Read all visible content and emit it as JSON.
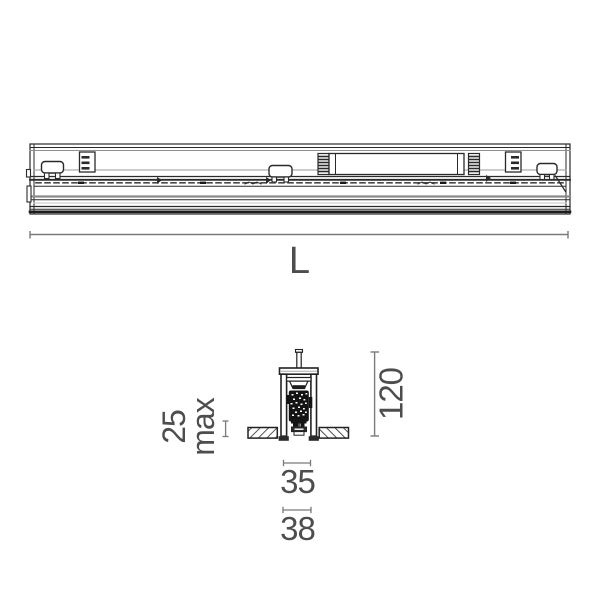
{
  "colors": {
    "linework": "#2a2a2a",
    "dimension_line": "#7a7a7a",
    "dimension_text": "#4d4d4d",
    "background": "#ffffff"
  },
  "drawing": {
    "dimensions": {
      "length": {
        "label": "L"
      },
      "height": {
        "value": "120"
      },
      "recess_depth": {
        "value": "25",
        "qualifier": "max"
      },
      "cutout_width": {
        "value": "35"
      },
      "overall_width": {
        "value": "38"
      }
    }
  }
}
